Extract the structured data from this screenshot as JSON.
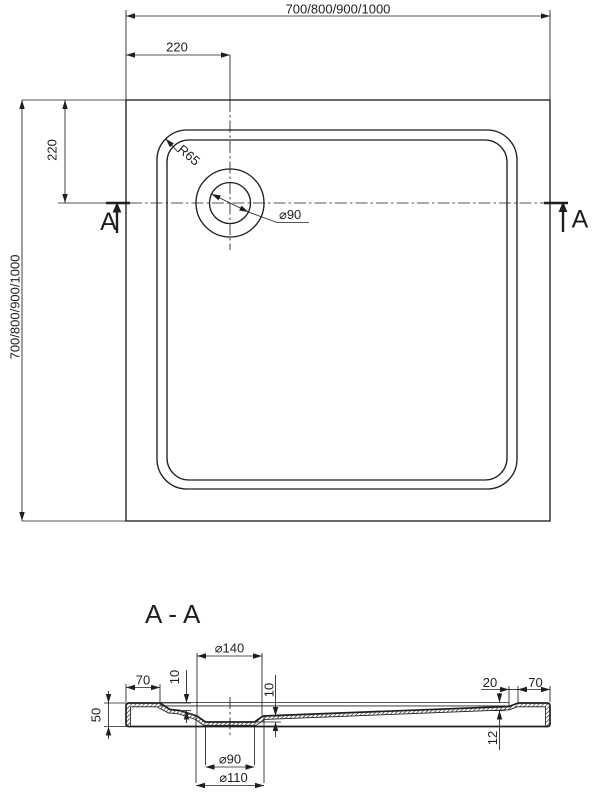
{
  "page": {
    "background": "#ffffff",
    "line_color": "#1f1f1f"
  },
  "top_view": {
    "width_dim": "700/800/900/1000",
    "height_dim": "700/800/900/1000",
    "drain_offset_horizontal": "220",
    "drain_offset_vertical": "220",
    "corner_radius": "R65",
    "drain_diameter": "⌀90",
    "section_marker_left": "A",
    "section_marker_right": "A"
  },
  "section_view": {
    "title": "A-A",
    "recess_diameter": "⌀140",
    "left_rim_width": "70",
    "left_step_depth": "10",
    "recess_depth": "10",
    "total_height": "50",
    "drain_hole_diameter": "⌀90",
    "flange_diameter": "⌀110",
    "right_step_width": "20",
    "right_rim_width": "70",
    "right_edge_height": "12"
  }
}
